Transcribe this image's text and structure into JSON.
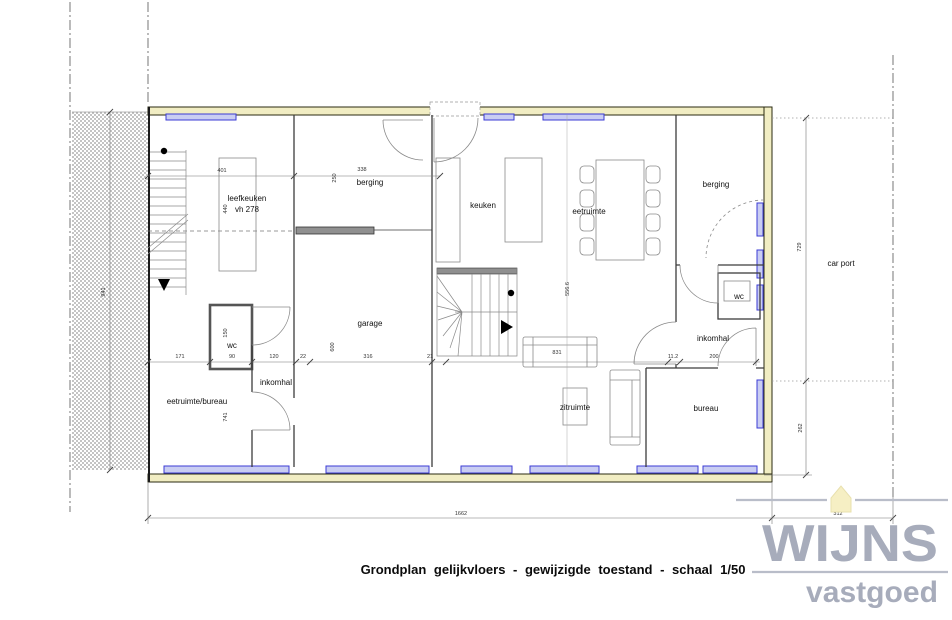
{
  "title": "Grondplan gelijkvloers - gewijzigde toestand - schaal 1/50",
  "logo": {
    "brand": "WIJNS",
    "tagline": "vastgoed"
  },
  "labels": {
    "leefkeuken_1": "leefkeuken",
    "leefkeuken_2": "vh 278",
    "berging_left": "berging",
    "berging_right": "berging",
    "keuken": "keuken",
    "eetruimte": "eetruimte",
    "garage": "garage",
    "zitruimte": "zitruimte",
    "bureau": "bureau",
    "carport": "car port",
    "wc_left": "wc",
    "wc_right": "wc",
    "inkomhal_left": "inkomhal",
    "inkomhal_right": "inkomhal",
    "eetruimte_bureau": "eetruimte/bureau"
  },
  "dims": {
    "leefkeuken_w": "401",
    "berging_left_w": "338",
    "leefkeuken_h": "440",
    "berging_left_h": "250",
    "left_total": "941",
    "m171": "171",
    "m90": "90",
    "m150": "150",
    "m120": "120",
    "m22": "22",
    "m316": "316",
    "m21": "21",
    "m600": "600",
    "m741": "741",
    "sofa": "831",
    "m112": "11.2",
    "m200": "200",
    "center_ref": "556.6",
    "carport_top": "729",
    "carport_bottom": "262",
    "total_w": "1662",
    "carport_w": "312"
  },
  "colors": {
    "wall_fill": "#f1edc3",
    "window_blue": "#3b3bd4",
    "window_fill": "#c9cdf2",
    "logo_gray": "#a7acbb",
    "house_fill": "#f6efc4"
  }
}
